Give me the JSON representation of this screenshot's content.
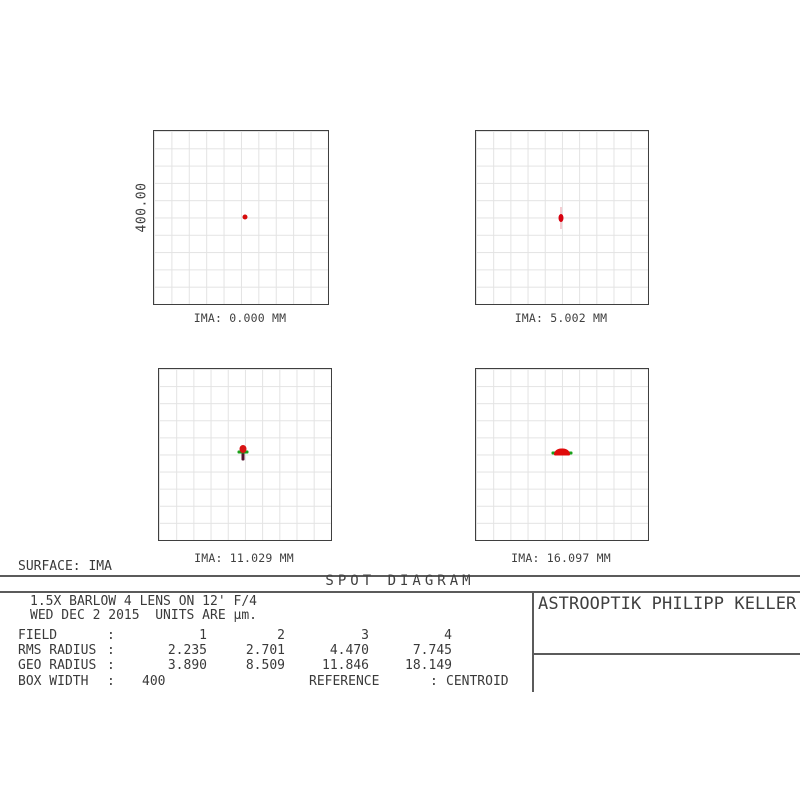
{
  "title": "SPOT DIAGRAM",
  "surface_label": "SURFACE: IMA",
  "scale_label": "400.00",
  "company": "ASTROOPTIK PHILIPP KELLER",
  "info": {
    "line1": "1.5X BARLOW 4 LENS ON 12' F/4",
    "line2": "WED DEC 2 2015  UNITS ARE µm."
  },
  "panels": [
    {
      "label": "IMA: 0.000 MM"
    },
    {
      "label": "IMA: 5.002 MM"
    },
    {
      "label": "IMA: 11.029 MM"
    },
    {
      "label": "IMA: 16.097 MM"
    }
  ],
  "table": {
    "rows": [
      {
        "label": "FIELD",
        "colon": ":",
        "values": [
          "1",
          "2",
          "3",
          "4"
        ]
      },
      {
        "label": "RMS RADIUS",
        "colon": ":",
        "values": [
          "2.235",
          "2.701",
          "4.470",
          "7.745"
        ]
      },
      {
        "label": "GEO RADIUS",
        "colon": ":",
        "values": [
          "3.890",
          "8.509",
          "11.846",
          "18.149"
        ]
      }
    ],
    "box_width_label": "BOX WIDTH",
    "box_width_colon": ":",
    "box_width_value": "400",
    "reference_label": "REFERENCE",
    "reference_colon": ":",
    "reference_value": "CENTROID"
  },
  "colors": {
    "spot_red": "#d80f0f",
    "spot_green": "#1aa11a",
    "spot_dark_tail": "#55122d",
    "spot_halo_pink": "#f4cdd2",
    "grid_line": "#e3e3e3",
    "box_frame": "#3f3f3f",
    "rule_gray": "#5b5b5b",
    "text": "#3a3a3a"
  },
  "chart_data": {
    "type": "scatter",
    "title": "SPOT DIAGRAM",
    "subtitle": "1.5X BARLOW 4 LENS ON 12' F/4",
    "date": "WED DEC 2 2015",
    "units": "µm",
    "surface": "IMA",
    "reference": "CENTROID",
    "box_width_um": 400,
    "scale_bar_label": "400.00",
    "grid": "10x10 light-gray grid per panel, dark frame",
    "legend_position": "none",
    "panels": [
      {
        "field": 1,
        "ima_mm": 0.0,
        "rms_radius_um": 2.235,
        "geo_radius_um": 3.89,
        "label": "IMA: 0.000 MM",
        "spot": {
          "x_center": true,
          "shape": "small round dot",
          "colors": [
            "red"
          ]
        }
      },
      {
        "field": 2,
        "ima_mm": 5.002,
        "rms_radius_um": 2.701,
        "geo_radius_um": 8.509,
        "label": "IMA: 5.002 MM",
        "spot": {
          "x_center": true,
          "shape": "small vertical oval with faint pink vertical halo",
          "colors": [
            "red"
          ]
        }
      },
      {
        "field": 3,
        "ima_mm": 11.029,
        "rms_radius_um": 4.47,
        "geo_radius_um": 11.846,
        "label": "IMA: 11.029 MM",
        "spot": {
          "x_center": true,
          "shape": "red cap over green horizontal dash with short dark vertical tail",
          "colors": [
            "red",
            "green",
            "dark-maroon-blue"
          ]
        }
      },
      {
        "field": 4,
        "ima_mm": 16.097,
        "rms_radius_um": 7.745,
        "geo_radius_um": 18.149,
        "label": "IMA: 16.097 MM",
        "spot": {
          "x_center": true,
          "shape": "horizontally elongated red dome with green wing tips",
          "colors": [
            "red",
            "green"
          ]
        }
      }
    ]
  }
}
